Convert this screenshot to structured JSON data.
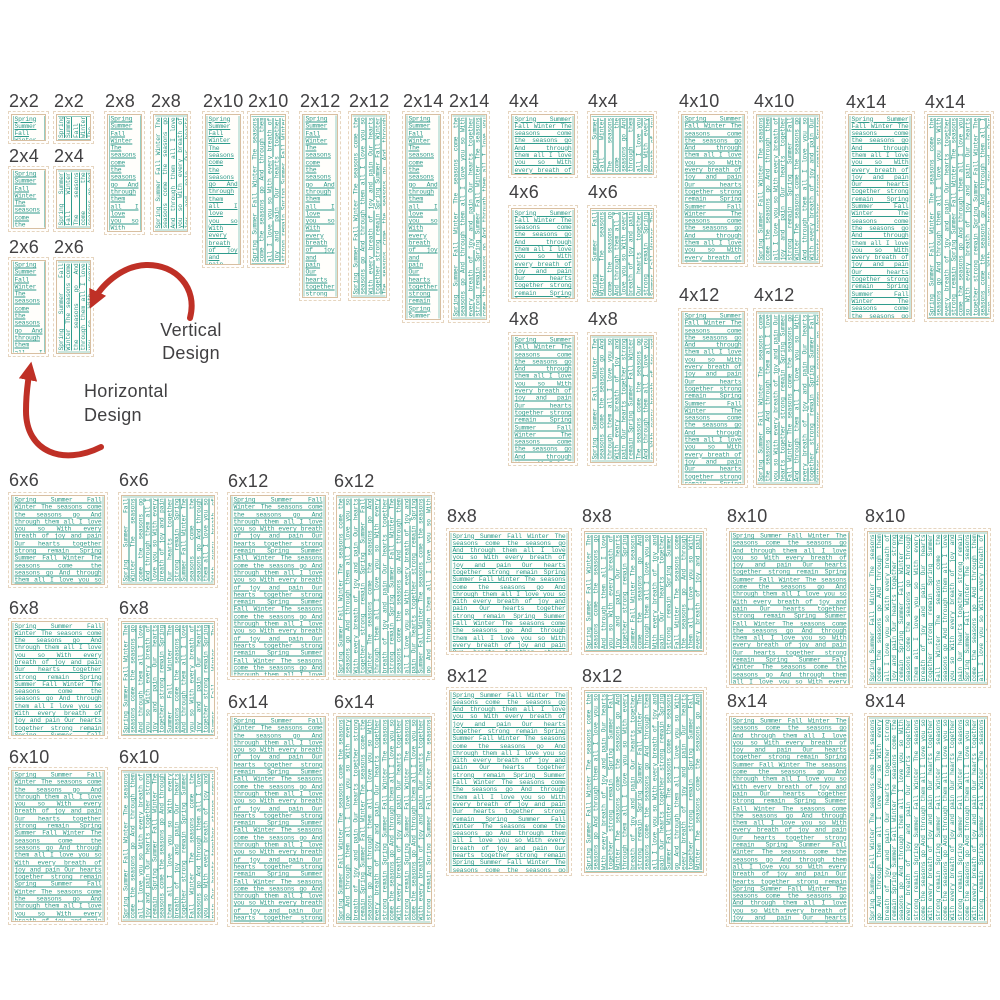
{
  "poem": "Spring Summer Fall Winter The seasons come the seasons go And through them all I love you so With every breath of joy and pain Our hearts together strong remain",
  "annotations": {
    "vertical": "Vertical Design",
    "horizontal": "Horizontal Design"
  },
  "colors": {
    "stitch": "#2f9b8b",
    "frame": "#d8bfa1",
    "frame_outer": "#e6d5bf",
    "label": "#414042",
    "arrow": "#bf3026",
    "background": "#ffffff"
  },
  "items": [
    {
      "label": "2x2",
      "variant": "horizontal",
      "x": 8,
      "ly": 91,
      "sy": 111,
      "w": 41,
      "h": 33
    },
    {
      "label": "2x2",
      "variant": "vertical",
      "x": 53,
      "ly": 91,
      "sy": 111,
      "w": 41,
      "h": 33
    },
    {
      "label": "2x4",
      "variant": "horizontal",
      "x": 8,
      "ly": 146,
      "sy": 166,
      "w": 41,
      "h": 66
    },
    {
      "label": "2x4",
      "variant": "vertical",
      "x": 53,
      "ly": 146,
      "sy": 166,
      "w": 41,
      "h": 66
    },
    {
      "label": "2x6",
      "variant": "horizontal",
      "x": 8,
      "ly": 237,
      "sy": 257,
      "w": 41,
      "h": 100
    },
    {
      "label": "2x6",
      "variant": "vertical",
      "x": 53,
      "ly": 237,
      "sy": 257,
      "w": 41,
      "h": 100
    },
    {
      "label": "2x8",
      "variant": "horizontal",
      "x": 104,
      "ly": 91,
      "sy": 111,
      "w": 41,
      "h": 124
    },
    {
      "label": "2x8",
      "variant": "vertical",
      "x": 150,
      "ly": 91,
      "sy": 111,
      "w": 41,
      "h": 124
    },
    {
      "label": "2x10",
      "variant": "horizontal",
      "x": 202,
      "ly": 91,
      "sy": 111,
      "w": 42,
      "h": 157
    },
    {
      "label": "2x10",
      "variant": "vertical",
      "x": 247,
      "ly": 91,
      "sy": 111,
      "w": 42,
      "h": 157
    },
    {
      "label": "2x12",
      "variant": "horizontal",
      "x": 299,
      "ly": 91,
      "sy": 111,
      "w": 42,
      "h": 190
    },
    {
      "label": "2x12",
      "variant": "vertical",
      "x": 348,
      "ly": 91,
      "sy": 111,
      "w": 42,
      "h": 190
    },
    {
      "label": "2x14",
      "variant": "horizontal",
      "x": 402,
      "ly": 91,
      "sy": 111,
      "w": 42,
      "h": 212
    },
    {
      "label": "2x14",
      "variant": "vertical",
      "x": 448,
      "ly": 91,
      "sy": 111,
      "w": 42,
      "h": 212
    },
    {
      "label": "4x4",
      "variant": "horizontal",
      "x": 508,
      "ly": 91,
      "sy": 111,
      "w": 70,
      "h": 67
    },
    {
      "label": "4x4",
      "variant": "vertical",
      "x": 587,
      "ly": 91,
      "sy": 111,
      "w": 70,
      "h": 67
    },
    {
      "label": "4x6",
      "variant": "horizontal",
      "x": 508,
      "ly": 182,
      "sy": 205,
      "w": 70,
      "h": 97
    },
    {
      "label": "4x6",
      "variant": "vertical",
      "x": 587,
      "ly": 182,
      "sy": 205,
      "w": 70,
      "h": 97
    },
    {
      "label": "4x8",
      "variant": "horizontal",
      "x": 508,
      "ly": 309,
      "sy": 332,
      "w": 70,
      "h": 134
    },
    {
      "label": "4x8",
      "variant": "vertical",
      "x": 587,
      "ly": 309,
      "sy": 332,
      "w": 70,
      "h": 134
    },
    {
      "label": "4x10",
      "variant": "horizontal",
      "x": 678,
      "ly": 91,
      "sy": 111,
      "w": 70,
      "h": 156
    },
    {
      "label": "4x10",
      "variant": "vertical",
      "x": 753,
      "ly": 91,
      "sy": 111,
      "w": 70,
      "h": 156
    },
    {
      "label": "4x12",
      "variant": "horizontal",
      "x": 678,
      "ly": 285,
      "sy": 308,
      "w": 70,
      "h": 180
    },
    {
      "label": "4x12",
      "variant": "vertical",
      "x": 753,
      "ly": 285,
      "sy": 308,
      "w": 70,
      "h": 180
    },
    {
      "label": "4x14",
      "variant": "horizontal",
      "x": 845,
      "ly": 92,
      "sy": 111,
      "w": 70,
      "h": 211
    },
    {
      "label": "4x14",
      "variant": "vertical",
      "x": 924,
      "ly": 92,
      "sy": 111,
      "w": 70,
      "h": 211
    },
    {
      "label": "6x6",
      "variant": "horizontal",
      "x": 8,
      "ly": 470,
      "sy": 492,
      "w": 100,
      "h": 96
    },
    {
      "label": "6x6",
      "variant": "vertical",
      "x": 118,
      "ly": 470,
      "sy": 492,
      "w": 100,
      "h": 96
    },
    {
      "label": "6x8",
      "variant": "horizontal",
      "x": 8,
      "ly": 598,
      "sy": 618,
      "w": 100,
      "h": 121
    },
    {
      "label": "6x8",
      "variant": "vertical",
      "x": 118,
      "ly": 598,
      "sy": 618,
      "w": 100,
      "h": 121
    },
    {
      "label": "6x10",
      "variant": "horizontal",
      "x": 8,
      "ly": 747,
      "sy": 767,
      "w": 100,
      "h": 158
    },
    {
      "label": "6x10",
      "variant": "vertical",
      "x": 118,
      "ly": 747,
      "sy": 767,
      "w": 100,
      "h": 158
    },
    {
      "label": "6x12",
      "variant": "horizontal",
      "x": 227,
      "ly": 471,
      "sy": 492,
      "w": 102,
      "h": 188
    },
    {
      "label": "6x12",
      "variant": "vertical",
      "x": 333,
      "ly": 471,
      "sy": 492,
      "w": 102,
      "h": 188
    },
    {
      "label": "6x14",
      "variant": "horizontal",
      "x": 227,
      "ly": 692,
      "sy": 713,
      "w": 102,
      "h": 214
    },
    {
      "label": "6x14",
      "variant": "vertical",
      "x": 333,
      "ly": 692,
      "sy": 713,
      "w": 102,
      "h": 214
    },
    {
      "label": "8x8",
      "variant": "horizontal",
      "x": 446,
      "ly": 506,
      "sy": 528,
      "w": 126,
      "h": 127
    },
    {
      "label": "8x8",
      "variant": "vertical",
      "x": 581,
      "ly": 506,
      "sy": 528,
      "w": 126,
      "h": 127
    },
    {
      "label": "8x12",
      "variant": "horizontal",
      "x": 446,
      "ly": 666,
      "sy": 687,
      "w": 126,
      "h": 189
    },
    {
      "label": "8x12",
      "variant": "vertical",
      "x": 581,
      "ly": 666,
      "sy": 687,
      "w": 126,
      "h": 189
    },
    {
      "label": "8x10",
      "variant": "horizontal",
      "x": 726,
      "ly": 506,
      "sy": 528,
      "w": 127,
      "h": 160
    },
    {
      "label": "8x10",
      "variant": "vertical",
      "x": 864,
      "ly": 506,
      "sy": 528,
      "w": 127,
      "h": 160
    },
    {
      "label": "8x14",
      "variant": "horizontal",
      "x": 726,
      "ly": 691,
      "sy": 713,
      "w": 127,
      "h": 214
    },
    {
      "label": "8x14",
      "variant": "vertical",
      "x": 864,
      "ly": 691,
      "sy": 713,
      "w": 127,
      "h": 214
    }
  ]
}
